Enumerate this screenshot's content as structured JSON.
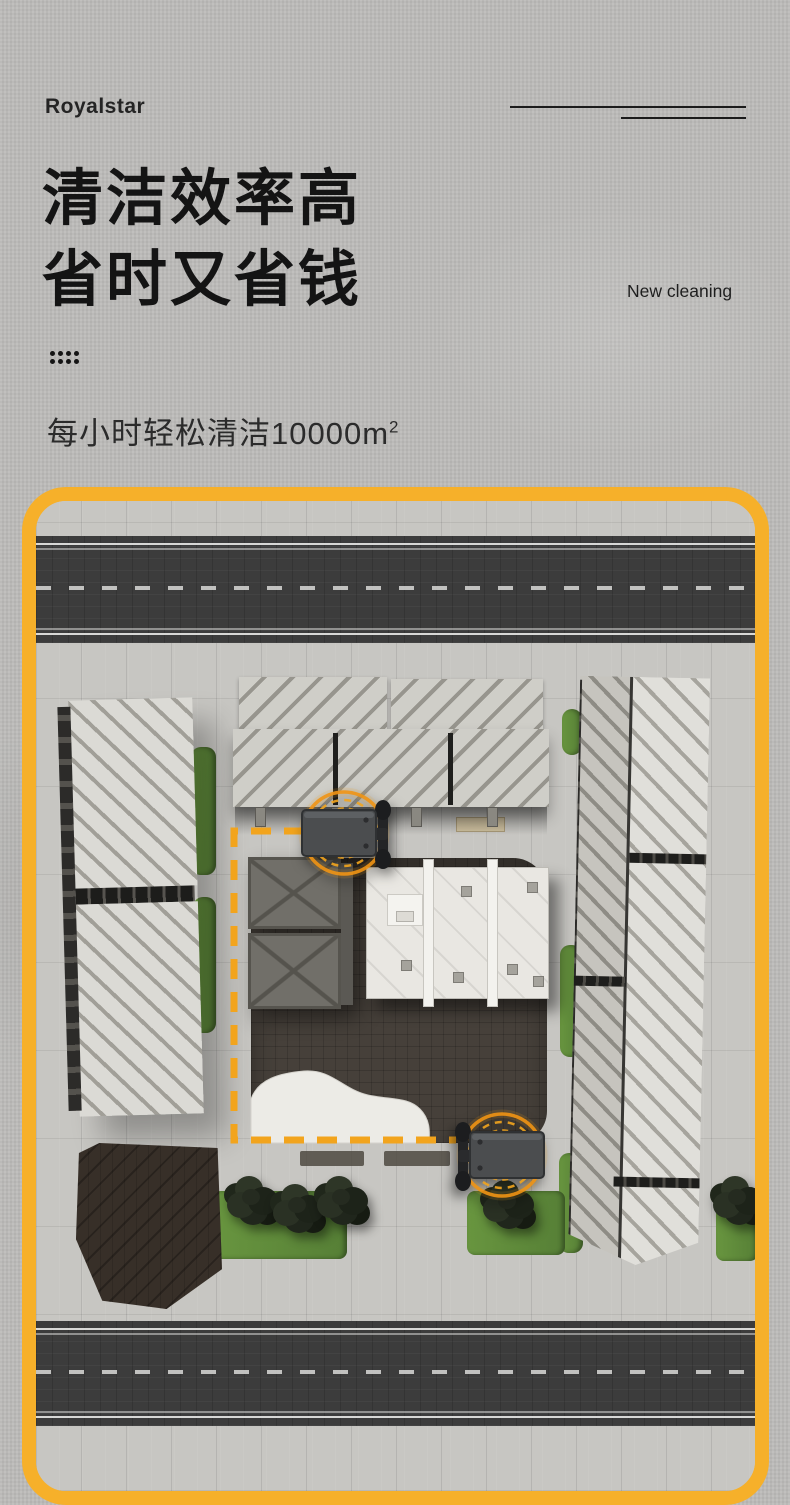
{
  "header": {
    "logo_text": "Royalstar",
    "title_line1": "清洁效率高",
    "title_line2": "省时又省钱",
    "tagline": "New cleaning",
    "subtitle_text": "每小时轻松清洁10000m",
    "subtitle_superscript": "2"
  },
  "colors": {
    "frame_yellow": "#F6B02A",
    "route_orange": "#F2A41D",
    "title_black": "#141414",
    "road_asphalt": "#3C3C3C",
    "paving_gray": "#C7C6C2",
    "courtyard_dark": "#46403A",
    "greenery_green": "#5E8D3F",
    "machine_gray": "#4B4D4F"
  },
  "scene": {
    "description": "Top-down aerial illustration of a plaza between striped-roof buildings, bordered by two asphalt roads, with hedges, trees, and two robot cleaning machines following a dashed cleaning route"
  }
}
